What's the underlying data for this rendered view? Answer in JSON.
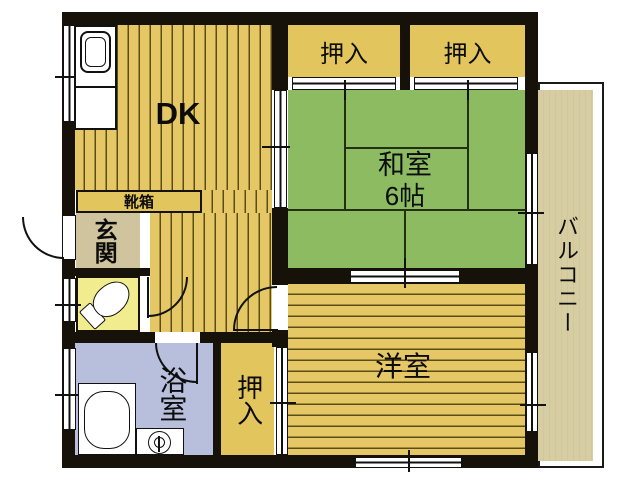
{
  "floor_plan": {
    "type": "japanese-apartment-floorplan",
    "rooms": {
      "dk": {
        "label": "DK"
      },
      "closet_top_left": {
        "label": "押入"
      },
      "closet_top_right": {
        "label": "押入"
      },
      "washitsu": {
        "label": "和室",
        "size": "6帖"
      },
      "youshitsu": {
        "label": "洋室"
      },
      "balcony": {
        "label": "バルコニー"
      },
      "shoe_box": {
        "label": "靴箱"
      },
      "genkan": {
        "label": "玄関"
      },
      "bathroom": {
        "label": "浴室"
      },
      "closet_bottom": {
        "label": "押入"
      }
    },
    "fixtures": [
      "kitchen-sink",
      "toilet",
      "bathtub",
      "washbasin-drain"
    ],
    "colors": {
      "wall": "#16120a",
      "flooring_base": "#e5c765",
      "flooring_stripe": "#5a4c18",
      "tatami": "#8cbb62",
      "closet": "#e3c55e",
      "genkan": "#cfc49d",
      "toilet_room": "#f1ed8f",
      "bathroom": "#b8bfdc",
      "balcony": "#d7cda2"
    }
  }
}
